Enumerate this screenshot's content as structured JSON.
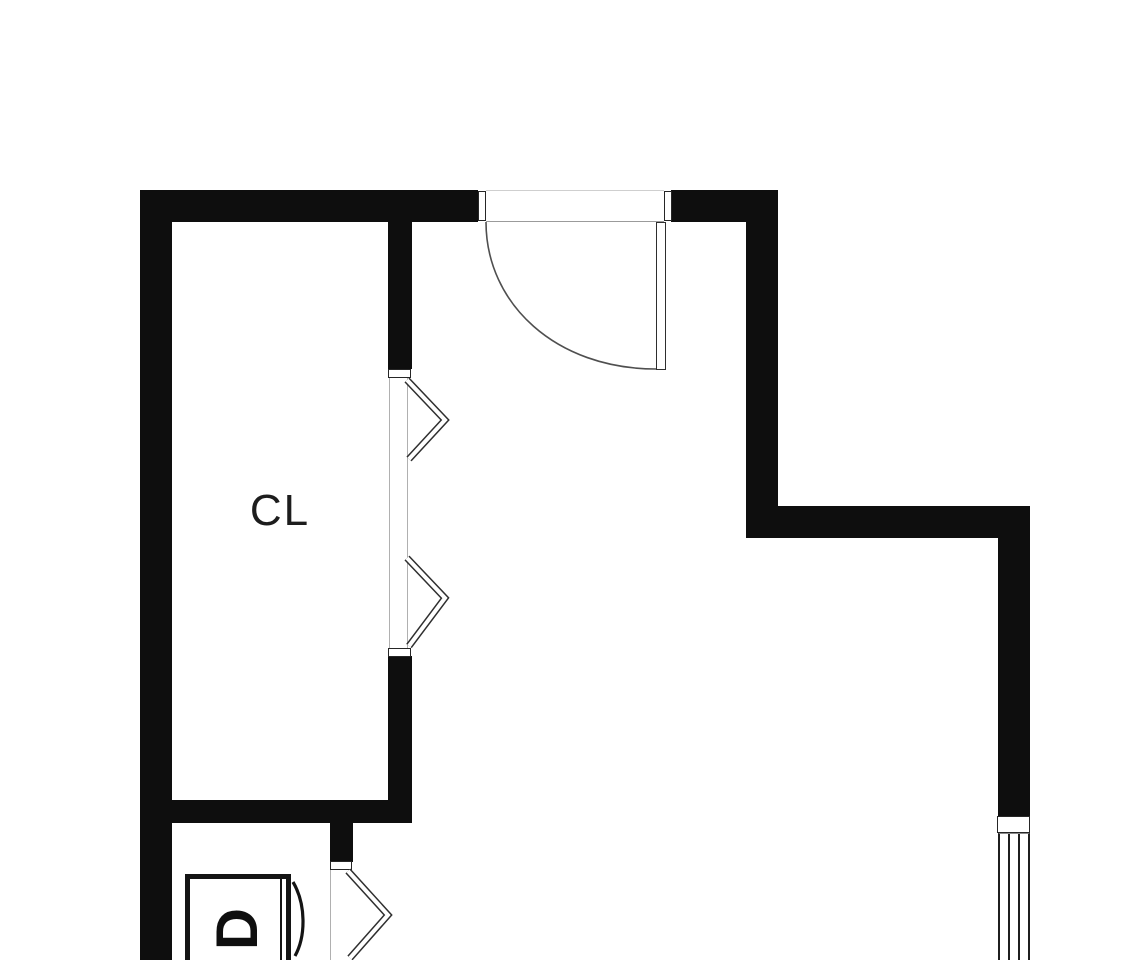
{
  "plan": {
    "type": "floor-plan",
    "labels": {
      "closet": "CL",
      "dryer": "D"
    },
    "colors": {
      "background": "#ffffff",
      "wall": "#0e0e0e",
      "fixture_line": "#2f2f2f",
      "hairline": "#9b9b9b",
      "text": "#1d1d1d"
    }
  }
}
